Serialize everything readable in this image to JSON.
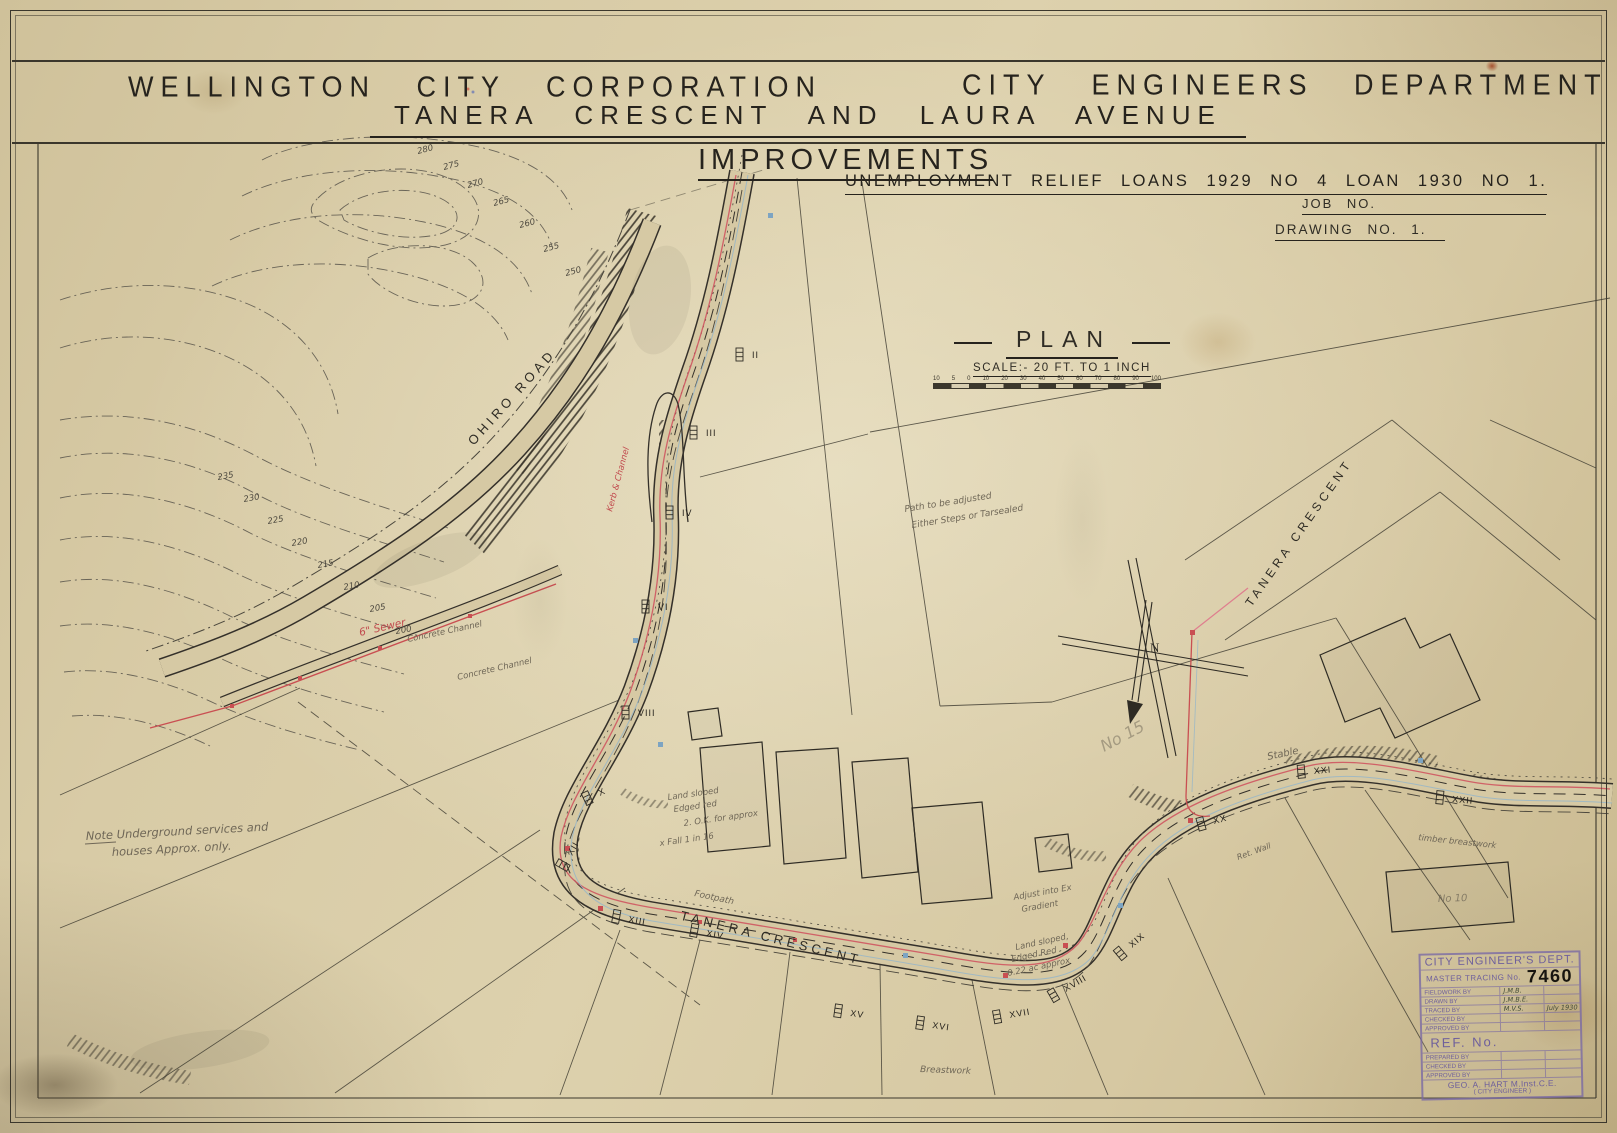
{
  "header": {
    "org": "WELLINGTON CITY CORPORATION",
    "dept": "CITY ENGINEERS DEPARTMENT",
    "subtitle": "TANERA CRESCENT AND LAURA AVENUE"
  },
  "project": {
    "improvements": "IMPROVEMENTS",
    "loans": "UNEMPLOYMENT RELIEF LOANS 1929 NO 4 LOAN 1930 NO 1.",
    "job_no": "JOB NO.",
    "drawing_no": "DRAWING NO. 1."
  },
  "plan": {
    "title": "PLAN",
    "scale_caption": "SCALE:- 20 FT. TO 1 INCH",
    "scale_ticks": [
      "10",
      "5",
      "0",
      "10",
      "20",
      "30",
      "40",
      "50",
      "60",
      "70",
      "80",
      "90",
      "100"
    ]
  },
  "roads": {
    "ohiro": "OHIRO ROAD",
    "tanera_right": "TANERA CRESCENT",
    "tanera_bottom": "TANERA CRESCENT",
    "footpath": "Footpath",
    "breastwork": "Breastwork"
  },
  "north_letter": "N",
  "notes": {
    "underground_1": "Note  Underground services and",
    "underground_2": "houses Approx. only.",
    "path_1": "Path to be adjusted",
    "path_2": "Either Steps or Tarsealed",
    "land1_1": "Land sloped",
    "land1_2": "Edged red",
    "land1_3": "2. O.K. for approx",
    "land1_4": "x Fall 1 in 16",
    "gradient_1": "Adjust into Ex",
    "gradient_2": "Gradient",
    "land2_1": "Land sloped,",
    "land2_2": "Edged Red",
    "land2_3": "0.22 ac approx",
    "concrete_a": "Concrete Channel",
    "concrete_b": "Concrete Channel",
    "sewer": "6\" Sewer",
    "kerb": "Kerb & Channel",
    "timber": "timber breastwork",
    "stable": "Stable",
    "ret_wall": "Ret. Wall",
    "no15": "No 15",
    "no10": "No 10"
  },
  "contours": {
    "upper": [
      "280",
      "275",
      "270",
      "265",
      "260",
      "255",
      "250"
    ],
    "left": [
      "235",
      "230",
      "225",
      "220",
      "215",
      "210",
      "205",
      "200"
    ]
  },
  "stations": [
    "II",
    "III",
    "IV",
    "VI",
    "VIII",
    "X",
    "XII",
    "XIII",
    "XIV",
    "XV",
    "XVI",
    "XVII",
    "XVIII",
    "XIX",
    "XX",
    "XXI",
    "XXII"
  ],
  "stamp": {
    "dept": "CITY ENGINEER'S DEPT.",
    "master_label": "MASTER TRACING No.",
    "number": "7460",
    "rows": [
      {
        "label": "FIELDWORK BY",
        "value": "J.M.B.",
        "extra": ""
      },
      {
        "label": "DRAWN BY",
        "value": "J.M.B.E.",
        "extra": ""
      },
      {
        "label": "TRACED BY",
        "value": "M.V.S.",
        "extra": "July 1930"
      },
      {
        "label": "CHECKED BY",
        "value": "",
        "extra": ""
      },
      {
        "label": "APPROVED BY",
        "value": "",
        "extra": ""
      }
    ],
    "ref": "REF. No.",
    "rows2": [
      "PREPARED BY",
      "CHECKED BY",
      "APPROVED BY"
    ],
    "engineer": "GEO. A. HART M.Inst.C.E.",
    "engineer_title": "( CITY ENGINEER )"
  },
  "colors": {
    "paper": "#d6c9a4",
    "ink": "#2f2c25",
    "red": "#c94f52",
    "pink": "#df7e8e",
    "blue": "#8fb3cc",
    "purple": "#7b6fae",
    "pencil": "#6f6757"
  }
}
